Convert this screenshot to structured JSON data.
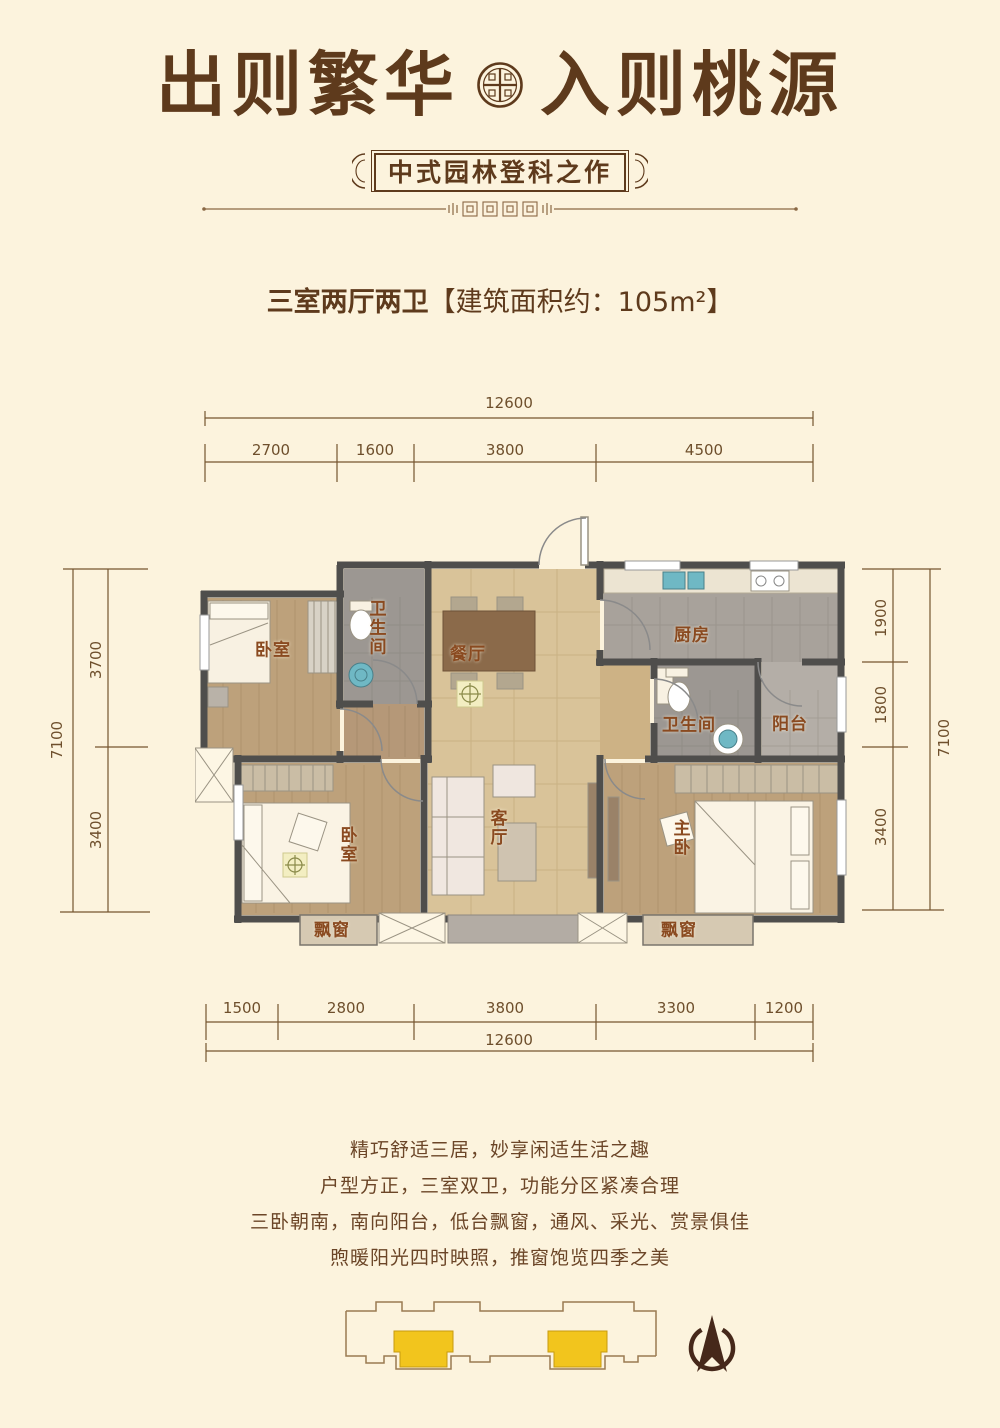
{
  "header": {
    "title_left": "出则繁华",
    "title_right": "入则桃源",
    "subtitle": "中式园林登科之作"
  },
  "unit": {
    "type_label": "三室两厅两卫",
    "area_label": "【建筑面积约：105m²】"
  },
  "dimensions": {
    "top_total": "12600",
    "top_segments": [
      "2700",
      "1600",
      "3800",
      "4500"
    ],
    "bottom_segments": [
      "1500",
      "2800",
      "3800",
      "3300",
      "1200"
    ],
    "bottom_total": "12600",
    "left_total": "7100",
    "left_segments": [
      "3700",
      "3400"
    ],
    "right_segments": [
      "1900",
      "1800",
      "3400"
    ],
    "right_total": "7100"
  },
  "rooms": {
    "bedroom_top": "卧室",
    "bath_top": "卫生间",
    "dining": "餐厅",
    "kitchen": "厨房",
    "bath_right": "卫生间",
    "balcony": "阳台",
    "bedroom_bottom": "卧室",
    "living": "客厅",
    "master": "主卧",
    "bay_left": "飘窗",
    "bay_right": "飘窗"
  },
  "description": {
    "lines": [
      "精巧舒适三居，妙享闲适生活之趣",
      "户型方正，三室双卫，功能分区紧凑合理",
      "三卧朝南，南向阳台，低台飘窗，通风、采光、赏景俱佳",
      "煦暖阳光四时映照，推窗饱览四季之美"
    ]
  },
  "key_plan": {
    "highlighted_units": "2"
  },
  "colors": {
    "background": "#fcf3dd",
    "brand_brown": "#5e3a1c",
    "dim_brown": "#75552f",
    "wall_gray": "#4f4e4c",
    "wood": "#bda17b",
    "marble": "#d9c399",
    "tile_gray": "#9c9792",
    "accent_yellow": "#f2c51d",
    "teal_fixture": "#6fb8c4",
    "compass_brown": "#46281a"
  }
}
